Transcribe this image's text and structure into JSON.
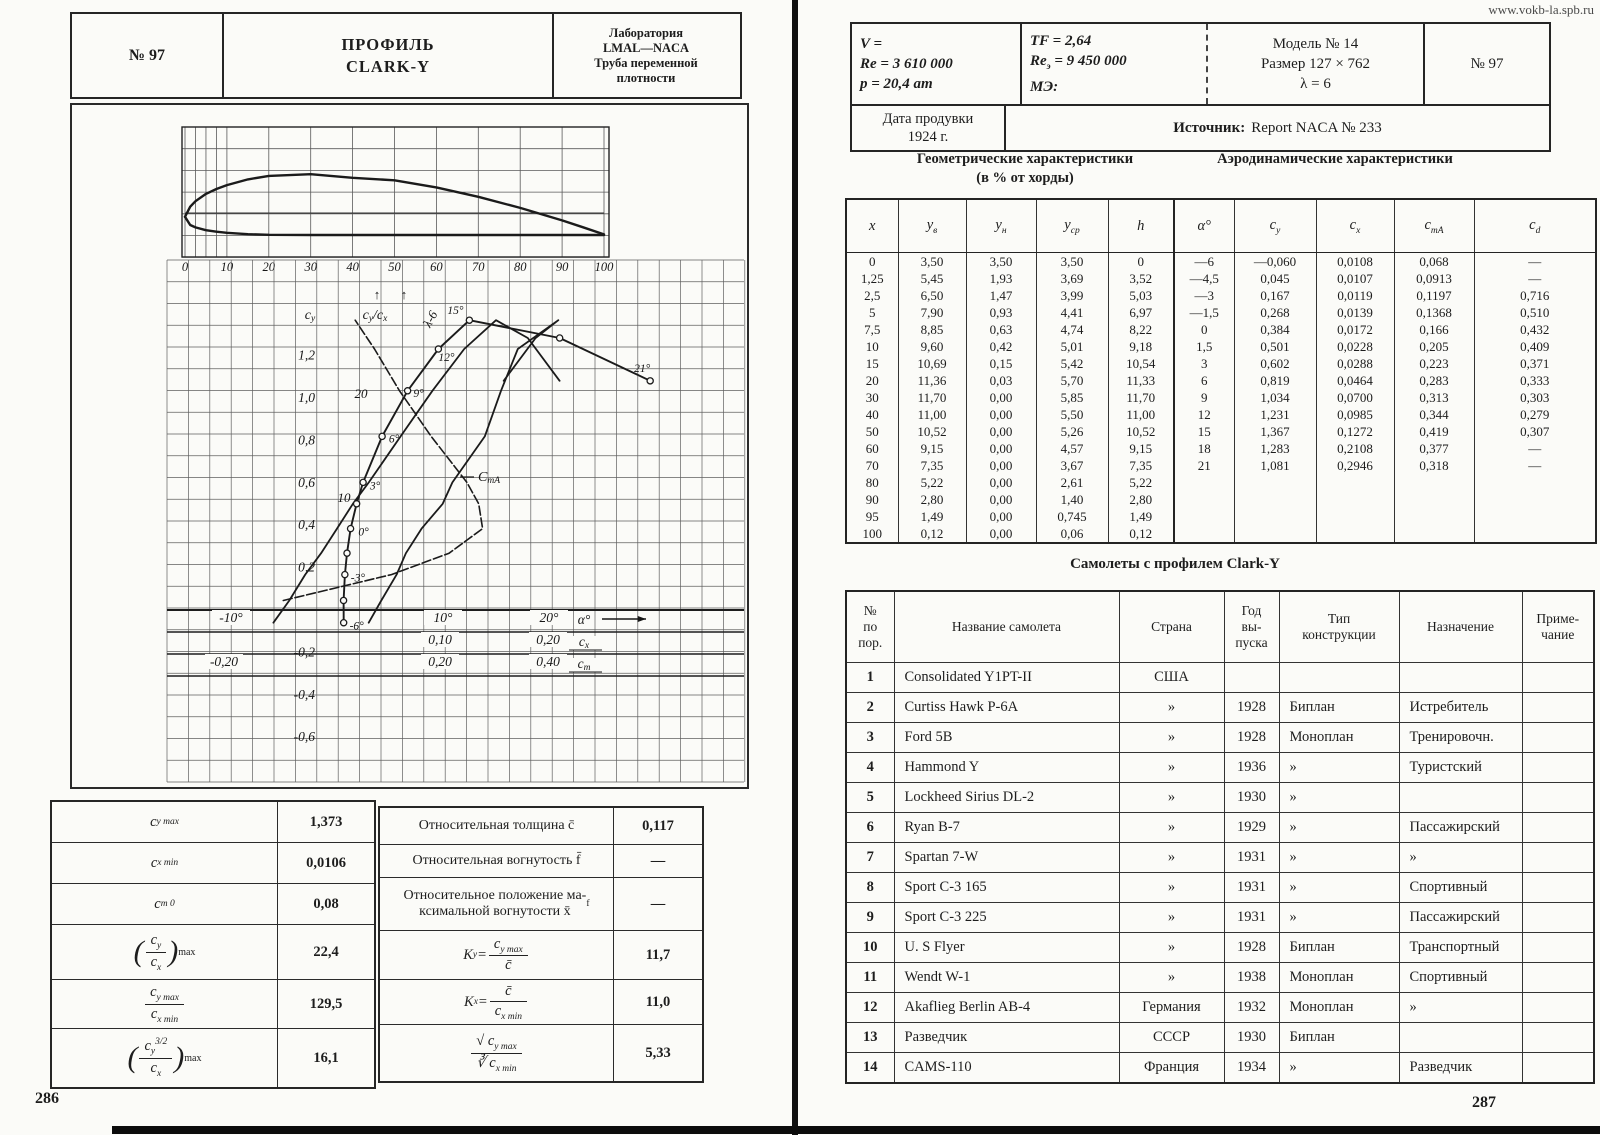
{
  "watermark": "www.vokb-la.spb.ru",
  "page_left": {
    "number": "286",
    "header": {
      "no": "№ 97",
      "title1": "ПРОФИЛЬ",
      "title2": "CLARK-Y",
      "lab_lines": [
        "Лаборатория",
        "LMAL—NACA",
        "Труба переменной",
        "плотности"
      ]
    },
    "cy_table": [
      {
        "label": {
          "f": "c_{y max}"
        },
        "value": "1,373"
      },
      {
        "label": {
          "f": "c_{x min}"
        },
        "value": "0,0106"
      },
      {
        "label": {
          "f": "c_{m 0}"
        },
        "value": "0,08"
      },
      {
        "label": {
          "paren": true,
          "num": "c_{y}",
          "den": "c_{x}",
          "sub": "max"
        },
        "value": "22,4"
      },
      {
        "label": {
          "num": "c_{y max}",
          "den": "c_{x min}"
        },
        "value": "129,5"
      },
      {
        "label": {
          "paren": true,
          "num": "c_{y}^{3/2}",
          "den": "c_{x}",
          "sub": "max"
        },
        "value": "16,1"
      }
    ],
    "k_table": [
      {
        "label": {
          "f": "Относительная толщина c̄"
        },
        "value": "0,117"
      },
      {
        "label": {
          "f": "Относительная вогнутость f̄"
        },
        "value": "—"
      },
      {
        "label": {
          "f": "Относительное положение ма-\nксимальной вогнутости x̄_{f}"
        },
        "value": "—"
      },
      {
        "label": {
          "pre": "K_{y} = ",
          "num": "c_{y max}",
          "den": "c̄"
        },
        "value": "11,7"
      },
      {
        "label": {
          "pre": "K_{x} = ",
          "num": "c̄",
          "den": "c_{x min}"
        },
        "value": "11,0"
      },
      {
        "label": {
          "num": "√ c_{y max}",
          "den": "∛ c_{x min}"
        },
        "value": "5,33"
      }
    ]
  },
  "page_right": {
    "number": "287",
    "header": {
      "col1_lines": [
        "V =",
        "Re = 3 610 000",
        "p = 20,4 ат"
      ],
      "col2_lines": [
        "TF = 2,64",
        "Re_{э} = 9 450 000",
        "МЭ:"
      ],
      "col3_lines": [
        "Модель № 14",
        "Размер 127 × 762",
        "λ = 6"
      ],
      "col4": "№ 97",
      "date_label": "Дата продувки",
      "date_value": "1924 г.",
      "source_label": "Источник:",
      "source_value": "Report NACA № 233"
    },
    "sections": {
      "geo_title": "Геометрические характеристики",
      "geo_sub": "(в % от хорды)",
      "aero_title": "Аэродинамические характеристики"
    },
    "main_table": {
      "headers": [
        "x",
        "y_{в}",
        "y_{н}",
        "y_{ср}",
        "h",
        "α°",
        "c_{y}",
        "c_{x}",
        "c_{mA}",
        "c_{d}"
      ],
      "rows": [
        [
          "0",
          "3,50",
          "3,50",
          "3,50",
          "0",
          "—6",
          "—0,060",
          "0,0108",
          "0,068",
          "—"
        ],
        [
          "1,25",
          "5,45",
          "1,93",
          "3,69",
          "3,52",
          "—4,5",
          "0,045",
          "0,0107",
          "0,0913",
          "—"
        ],
        [
          "2,5",
          "6,50",
          "1,47",
          "3,99",
          "5,03",
          "—3",
          "0,167",
          "0,0119",
          "0,1197",
          "0,716"
        ],
        [
          "5",
          "7,90",
          "0,93",
          "4,41",
          "6,97",
          "—1,5",
          "0,268",
          "0,0139",
          "0,1368",
          "0,510"
        ],
        [
          "7,5",
          "8,85",
          "0,63",
          "4,74",
          "8,22",
          "0",
          "0,384",
          "0,0172",
          "0,166",
          "0,432"
        ],
        [
          "10",
          "9,60",
          "0,42",
          "5,01",
          "9,18",
          "1,5",
          "0,501",
          "0,0228",
          "0,205",
          "0,409"
        ],
        [
          "15",
          "10,69",
          "0,15",
          "5,42",
          "10,54",
          "3",
          "0,602",
          "0,0288",
          "0,223",
          "0,371"
        ],
        [
          "20",
          "11,36",
          "0,03",
          "5,70",
          "11,33",
          "6",
          "0,819",
          "0,0464",
          "0,283",
          "0,333"
        ],
        [
          "30",
          "11,70",
          "0,00",
          "5,85",
          "11,70",
          "9",
          "1,034",
          "0,0700",
          "0,313",
          "0,303"
        ],
        [
          "40",
          "11,00",
          "0,00",
          "5,50",
          "11,00",
          "12",
          "1,231",
          "0,0985",
          "0,344",
          "0,279"
        ],
        [
          "50",
          "10,52",
          "0,00",
          "5,26",
          "10,52",
          "15",
          "1,367",
          "0,1272",
          "0,419",
          "0,307"
        ],
        [
          "60",
          "9,15",
          "0,00",
          "4,57",
          "9,15",
          "18",
          "1,283",
          "0,2108",
          "0,377",
          "—"
        ],
        [
          "70",
          "7,35",
          "0,00",
          "3,67",
          "7,35",
          "21",
          "1,081",
          "0,2946",
          "0,318",
          "—"
        ],
        [
          "80",
          "5,22",
          "0,00",
          "2,61",
          "5,22",
          "",
          "",
          "",
          "",
          ""
        ],
        [
          "90",
          "2,80",
          "0,00",
          "1,40",
          "2,80",
          "",
          "",
          "",
          "",
          ""
        ],
        [
          "95",
          "1,49",
          "0,00",
          "0,745",
          "1,49",
          "",
          "",
          "",
          "",
          ""
        ],
        [
          "100",
          "0,12",
          "0,00",
          "0,06",
          "0,12",
          "",
          "",
          "",
          "",
          ""
        ]
      ]
    },
    "aircraft": {
      "title": "Самолеты с профилем Clark-Y",
      "headers": [
        "№\nпо\nпор.",
        "Название самолета",
        "Страна",
        "Год\nвы-\nпуска",
        "Тип\nконструкции",
        "Назначение",
        "Приме-\nчание"
      ],
      "rows": [
        [
          "1",
          "Consolidated Y1PT-II",
          "США",
          "",
          "",
          "",
          ""
        ],
        [
          "2",
          "Curtiss Hawk P-6A",
          "»",
          "1928",
          "Биплан",
          "Истребитель",
          ""
        ],
        [
          "3",
          "Ford 5B",
          "»",
          "1928",
          "Моноплан",
          "Тренировочн.",
          ""
        ],
        [
          "4",
          "Hammond Y",
          "»",
          "1936",
          "»",
          "Туристский",
          ""
        ],
        [
          "5",
          "Lockheed Sirius DL-2",
          "»",
          "1930",
          "»",
          "",
          ""
        ],
        [
          "6",
          "Ryan B-7",
          "»",
          "1929",
          "»",
          "Пассажирский",
          ""
        ],
        [
          "7",
          "Spartan 7-W",
          "»",
          "1931",
          "»",
          "»",
          ""
        ],
        [
          "8",
          "Sport C-3 165",
          "»",
          "1931",
          "»",
          "Спортивный",
          ""
        ],
        [
          "9",
          "Sport C-3 225",
          "»",
          "1931",
          "»",
          "Пассажирский",
          ""
        ],
        [
          "10",
          "U. S Flyer",
          "»",
          "1928",
          "Биплан",
          "Транспортный",
          ""
        ],
        [
          "11",
          "Wendt W-1",
          "»",
          "1938",
          "Моноплан",
          "Спортивный",
          ""
        ],
        [
          "12",
          "Akaflieg Berlin AB-4",
          "Германия",
          "1932",
          "Моноплан",
          "»",
          ""
        ],
        [
          "13",
          "Разведчик",
          "СССР",
          "1930",
          "Биплан",
          "",
          ""
        ],
        [
          "14",
          "CAMS-110",
          "Франция",
          "1934",
          "»",
          "Разведчик",
          ""
        ]
      ]
    }
  },
  "chart_data": [
    {
      "type": "line",
      "name": "airfoil-profile",
      "title": "Clark-Y profile (% of chord)",
      "x": [
        0,
        1.25,
        2.5,
        5,
        7.5,
        10,
        15,
        20,
        30,
        40,
        50,
        60,
        70,
        80,
        90,
        95,
        100
      ],
      "upper": [
        3.5,
        5.45,
        6.5,
        7.9,
        8.85,
        9.6,
        10.69,
        11.36,
        11.7,
        11.0,
        10.52,
        9.15,
        7.35,
        5.22,
        2.8,
        1.49,
        0.12
      ],
      "lower": [
        3.5,
        1.93,
        1.47,
        0.93,
        0.63,
        0.42,
        0.15,
        0.03,
        0.0,
        0.0,
        0.0,
        0.0,
        0.0,
        0.0,
        0.0,
        0.0,
        0.0
      ],
      "xticks": [
        {
          "v": 0,
          "t": "0"
        },
        {
          "v": 10,
          "t": "10"
        },
        {
          "v": 20,
          "t": "20"
        },
        {
          "v": 30,
          "t": "30"
        },
        {
          "v": 40,
          "t": "40"
        },
        {
          "v": 50,
          "t": "50"
        },
        {
          "v": 60,
          "t": "60"
        },
        {
          "v": 70,
          "t": "70"
        },
        {
          "v": 80,
          "t": "80"
        },
        {
          "v": 90,
          "t": "90"
        },
        {
          "v": 100,
          "t": "100"
        }
      ],
      "xlim": [
        0,
        100
      ]
    },
    {
      "type": "line",
      "name": "polar-diagram",
      "alpha": [
        -6,
        -4.5,
        -3,
        -1.5,
        0,
        1.5,
        3,
        6,
        9,
        12,
        15,
        18,
        21
      ],
      "cy": [
        -0.06,
        0.045,
        0.167,
        0.268,
        0.384,
        0.501,
        0.602,
        0.819,
        1.034,
        1.231,
        1.367,
        1.283,
        1.081
      ],
      "cx": [
        0.0108,
        0.0107,
        0.0119,
        0.0139,
        0.0172,
        0.0228,
        0.0288,
        0.0464,
        0.07,
        0.0985,
        0.1272,
        0.2108,
        0.2946
      ],
      "cma": [
        0.068,
        0.0913,
        0.1197,
        0.1368,
        0.166,
        0.205,
        0.223,
        0.283,
        0.313,
        0.344,
        0.419,
        0.377,
        0.318
      ],
      "cd": [
        null,
        null,
        0.716,
        0.51,
        0.432,
        0.409,
        0.371,
        0.333,
        0.303,
        0.279,
        0.307,
        null,
        null
      ],
      "labels": {
        "cy": "c_{y}",
        "cycx": "c_{y}/c_{x}",
        "lambda": "λ-6",
        "cma": "C_{mA}",
        "alpha": "α°",
        "cx": "c_{x}",
        "cm": "c_{m}",
        "scale20": "20",
        "scale10": "10"
      },
      "y_ticks": [
        {
          "v": 1.2,
          "t": "1,2"
        },
        {
          "v": 1.0,
          "t": "1,0"
        },
        {
          "v": 0.8,
          "t": "0,8"
        },
        {
          "v": 0.6,
          "t": "0,6"
        },
        {
          "v": 0.4,
          "t": "0,4"
        },
        {
          "v": 0.2,
          "t": "0,2"
        },
        {
          "v": -0.2,
          "t": "-0,2"
        },
        {
          "v": -0.4,
          "t": "-0,4"
        },
        {
          "v": -0.6,
          "t": "-0,6"
        }
      ],
      "alpha_axis": [
        {
          "v": -10,
          "t": "-10°"
        },
        {
          "v": 10,
          "t": "10°"
        },
        {
          "v": 20,
          "t": "20°"
        }
      ],
      "cx_axis": [
        {
          "v": 0.1,
          "t": "0,10"
        },
        {
          "v": 0.2,
          "t": "0,20"
        }
      ],
      "cm_axis": [
        {
          "v": -0.2,
          "t": "-0,20"
        },
        {
          "v": 0.2,
          "t": "0,20"
        },
        {
          "v": 0.4,
          "t": "0,40"
        }
      ],
      "marker_labels": [
        {
          "a": -6,
          "t": "-6°"
        },
        {
          "a": -3,
          "t": "-3°"
        },
        {
          "a": 0,
          "t": "0°"
        },
        {
          "a": 3,
          "t": "3°"
        },
        {
          "a": 6,
          "t": "6°"
        },
        {
          "a": 9,
          "t": "9°"
        },
        {
          "a": 12,
          "t": "12°"
        },
        {
          "a": 15,
          "t": "15°"
        },
        {
          "a": 21,
          "t": "21°"
        }
      ],
      "ylim": [
        -0.8,
        1.5
      ]
    }
  ]
}
